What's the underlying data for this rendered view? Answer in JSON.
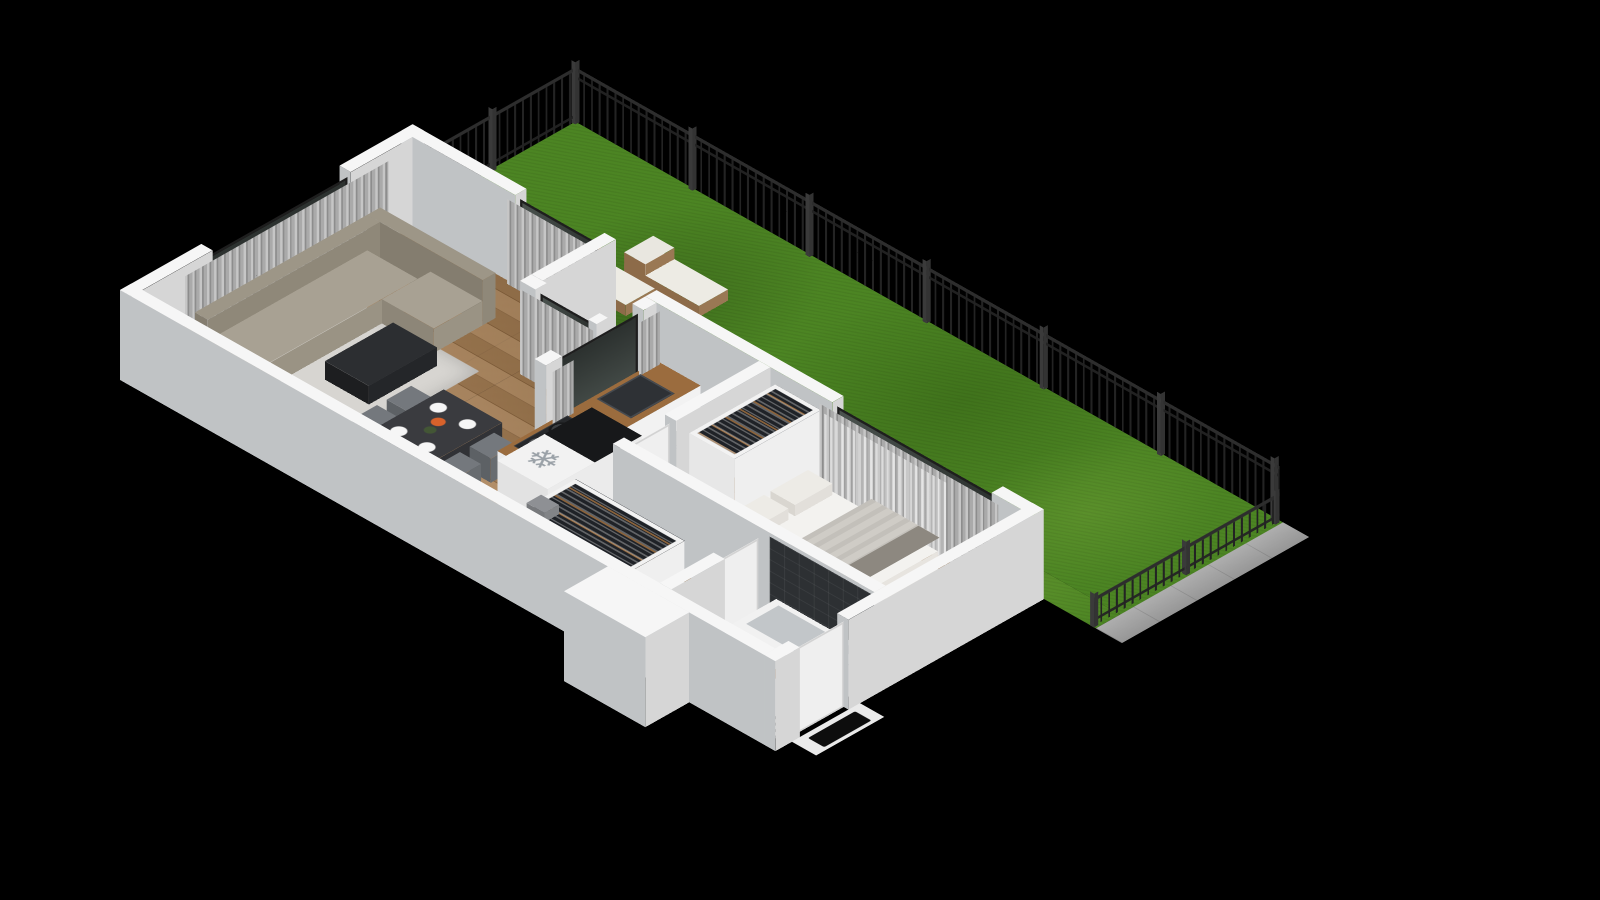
{
  "meta": {
    "description": "3D isometric floor plan rendering of a one-bedroom apartment with a fenced garden terrace",
    "background": "#000000"
  },
  "palette": {
    "wall_top": "#f6f6f6",
    "wall_sw": "#c0c3c5",
    "wall_se": "#d6d6d6",
    "wood_floor": "#ad8254",
    "grass": "#4c8523",
    "fence": "#2d2d2d",
    "sofa": "#a29b8d",
    "curtain": "#aaaaaa",
    "glass": "#39403d",
    "counter_wood": "#9b6c3e",
    "bed": "#f3f2ef",
    "dark_tile": "#2d3033",
    "pavement": "#a7a7a7"
  },
  "icons": {
    "snowflake": "❄"
  },
  "flats": [
    {
      "n": "garden-lawn",
      "x": 360,
      "y": 0,
      "w": 200,
      "d": 870,
      "cls": "grass"
    },
    {
      "n": "garden-lawn-strip",
      "x": 330,
      "y": 250,
      "w": 30,
      "d": 620,
      "cls": "grass"
    },
    {
      "n": "terrace-lawn-notch",
      "x": 270,
      "y": 250,
      "w": 90,
      "d": 80,
      "cls": "grass"
    },
    {
      "n": "pavement",
      "x": 330,
      "y": 870,
      "w": 230,
      "d": 32,
      "cls": "pavement"
    },
    {
      "n": "floor-living",
      "x": 14,
      "y": 14,
      "w": 332,
      "d": 222,
      "cls": "wood"
    },
    {
      "n": "floor-dining",
      "x": 14,
      "y": 236,
      "w": 242,
      "d": 94,
      "cls": "wood"
    },
    {
      "n": "floor-kitchen",
      "x": 14,
      "y": 330,
      "w": 302,
      "d": 130,
      "cls": "wood"
    },
    {
      "n": "floor-kitchen-tiles",
      "x": 150,
      "y": 344,
      "w": 166,
      "d": 116,
      "cls": "tile-kitchen"
    },
    {
      "n": "floor-hallway",
      "x": 14,
      "y": 460,
      "w": 122,
      "d": 190,
      "cls": "wood"
    },
    {
      "n": "floor-bedroom",
      "x": 150,
      "y": 484,
      "w": 166,
      "d": 308,
      "cls": "wood"
    },
    {
      "n": "floor-bathroom",
      "x": 14,
      "y": 664,
      "w": 122,
      "d": 128,
      "cls": "tile-bath"
    },
    {
      "n": "floor-shower",
      "x": 14,
      "y": 664,
      "w": 64,
      "d": 56,
      "cls": "shower"
    },
    {
      "n": "entry-threshold",
      "x": 20,
      "y": 806,
      "w": 84,
      "d": 30,
      "t": "#eaeaea"
    },
    {
      "n": "entry-doormat",
      "x": 34,
      "y": 812,
      "w": 58,
      "d": 20,
      "cls": "mat"
    },
    {
      "n": "living-rug",
      "x": 50,
      "y": 36,
      "w": 180,
      "d": 176,
      "cls": "rug"
    },
    {
      "n": "dining-table-setting",
      "x": 68,
      "y": 244,
      "w": 86,
      "d": 64,
      "z": 31,
      "cls": "plates"
    },
    {
      "n": "cooktop",
      "x": 134,
      "y": 350,
      "w": 66,
      "d": 42,
      "z": 35,
      "cls": "cooktop"
    },
    {
      "n": "kitchen-sink",
      "x": 236,
      "y": 350,
      "w": 54,
      "d": 42,
      "z": 35,
      "cls": "sink"
    },
    {
      "n": "snowflake-icon",
      "x": 66,
      "y": 410,
      "w": 46,
      "d": 46,
      "z": 83,
      "cls": "glyph",
      "glyph": "snowflake"
    },
    {
      "n": "bed-blanket",
      "x": 168,
      "y": 646,
      "w": 110,
      "d": 82,
      "z": 53,
      "cls": "blanket"
    },
    {
      "n": "bed-throw",
      "x": 168,
      "y": 704,
      "w": 110,
      "d": 26,
      "z": 53,
      "t": "#8d8880"
    },
    {
      "n": "tub-basin",
      "x": 88,
      "y": 682,
      "w": 40,
      "d": 96,
      "z": 31,
      "t": "#c2c6c9"
    },
    {
      "n": "vanity-basin",
      "x": 24,
      "y": 712,
      "w": 20,
      "d": 38,
      "z": 39,
      "cls": "basin"
    }
  ],
  "boxes": [
    {
      "n": "wall-nw-west",
      "x": 0,
      "y": 0,
      "w": 100,
      "d": 14,
      "h": 95,
      "wall": true
    },
    {
      "n": "wall-nw-east",
      "x": 270,
      "y": 0,
      "w": 90,
      "d": 14,
      "h": 95,
      "wall": true
    },
    {
      "n": "wall-ne-living",
      "x": 346,
      "y": 0,
      "w": 14,
      "d": 140,
      "h": 95,
      "wall": true
    },
    {
      "n": "wall-terrace-nw",
      "x": 270,
      "y": 236,
      "w": 90,
      "d": 14,
      "h": 95,
      "wall": true
    },
    {
      "n": "wall-terrace-sw-a",
      "x": 256,
      "y": 236,
      "w": 14,
      "d": 19,
      "h": 95,
      "wall": true
    },
    {
      "n": "wall-terrace-sw-b",
      "x": 256,
      "y": 320,
      "w": 14,
      "d": 10,
      "h": 95,
      "wall": true
    },
    {
      "n": "wall-kitchen-nw-a",
      "x": 180,
      "y": 330,
      "w": 20,
      "d": 14,
      "h": 95,
      "wall": true
    },
    {
      "n": "wall-kitchen-nw-b",
      "x": 300,
      "y": 330,
      "w": 16,
      "d": 14,
      "h": 95,
      "wall": true
    },
    {
      "n": "wall-ne-kitchen-bedroom",
      "x": 316,
      "y": 330,
      "w": 14,
      "d": 230,
      "h": 95,
      "wall": true
    },
    {
      "n": "wall-ne-bedroom-end",
      "x": 316,
      "y": 756,
      "w": 14,
      "d": 50,
      "h": 95,
      "wall": true
    },
    {
      "n": "wall-se-a",
      "x": 0,
      "y": 792,
      "w": 30,
      "d": 14,
      "h": 95,
      "wall": true
    },
    {
      "n": "wall-se-b",
      "x": 90,
      "y": 792,
      "w": 240,
      "d": 14,
      "h": 95,
      "wall": true
    },
    {
      "n": "wall-sw",
      "x": 0,
      "y": 0,
      "w": 14,
      "d": 792,
      "h": 95,
      "wall": true
    },
    {
      "n": "wall-stub-exterior",
      "x": -54,
      "y": 600,
      "w": 54,
      "d": 100,
      "h": 95,
      "wall": true
    },
    {
      "n": "wall-bedroom-sw",
      "x": 136,
      "y": 470,
      "w": 14,
      "d": 322,
      "h": 95,
      "wall": true
    },
    {
      "n": "wall-bedroom-nw",
      "x": 200,
      "y": 470,
      "w": 116,
      "d": 14,
      "h": 95,
      "wall": true
    },
    {
      "n": "wall-bathroom-nw",
      "x": 14,
      "y": 650,
      "w": 66,
      "d": 14,
      "h": 95,
      "wall": true
    },
    {
      "n": "sofa-back",
      "x": 70,
      "y": 22,
      "w": 212,
      "d": 16,
      "h": 48,
      "t": "#9d9687",
      "s1": "#847d6f",
      "s2": "#8f8879"
    },
    {
      "n": "sofa-armrest",
      "x": 54,
      "y": 22,
      "w": 16,
      "d": 80,
      "h": 40,
      "t": "#9d9687",
      "s1": "#847d6f",
      "s2": "#8f8879"
    },
    {
      "n": "sofa-seat",
      "x": 70,
      "y": 38,
      "w": 196,
      "d": 62,
      "h": 26,
      "t": "#a8a193",
      "s1": "#8d8678",
      "s2": "#9a9384"
    },
    {
      "n": "sofa-back-corner",
      "x": 282,
      "y": 22,
      "w": 16,
      "d": 142,
      "h": 48,
      "t": "#9d9687",
      "s1": "#847d6f",
      "s2": "#8f8879"
    },
    {
      "n": "sofa-chaise",
      "x": 222,
      "y": 100,
      "w": 60,
      "d": 64,
      "h": 26,
      "t": "#a8a193",
      "s1": "#8d8678",
      "s2": "#9a9384"
    },
    {
      "n": "coffee-table",
      "x": 126,
      "y": 126,
      "w": 84,
      "d": 54,
      "h": 20,
      "t": "#2c2e31",
      "s1": "#1d1e20",
      "s2": "#242629"
    },
    {
      "n": "dining-table",
      "x": 64,
      "y": 240,
      "w": 94,
      "d": 72,
      "h": 30,
      "t": "#3a3b3f",
      "s1": "#27282b",
      "s2": "#313236"
    },
    {
      "n": "dining-chair-1",
      "x": 74,
      "y": 212,
      "w": 30,
      "d": 26,
      "h": 26,
      "t": "#74787d",
      "s1": "#5d6165",
      "s2": "#686c70"
    },
    {
      "n": "dining-chair-2",
      "x": 116,
      "y": 212,
      "w": 30,
      "d": 26,
      "h": 26,
      "t": "#74787d",
      "s1": "#5d6165",
      "s2": "#686c70"
    },
    {
      "n": "dining-chair-3",
      "x": 74,
      "y": 314,
      "w": 30,
      "d": 26,
      "h": 26,
      "t": "#74787d",
      "s1": "#5d6165",
      "s2": "#686c70"
    },
    {
      "n": "dining-chair-4",
      "x": 116,
      "y": 314,
      "w": 30,
      "d": 26,
      "h": 26,
      "t": "#74787d",
      "s1": "#5d6165",
      "s2": "#686c70"
    },
    {
      "n": "living-plant",
      "x": 20,
      "y": 214,
      "w": 18,
      "d": 18,
      "h": 14,
      "t": "#4e7d35",
      "s1": "#2e2e2e",
      "s2": "#3a3a3a"
    },
    {
      "n": "kitchen-counter",
      "x": 120,
      "y": 344,
      "w": 196,
      "d": 54,
      "h": 34,
      "t": "#9b6c3e",
      "s1": "#ececec",
      "s2": "#f2f2f2"
    },
    {
      "n": "kitchen-faucet",
      "x": 254,
      "y": 344,
      "w": 10,
      "d": 8,
      "h": 14,
      "t": "#2b2b2b",
      "s1": "#1f1f1f",
      "s2": "#262626"
    },
    {
      "n": "fridge",
      "x": 60,
      "y": 404,
      "w": 58,
      "d": 62,
      "h": 82,
      "t": "#f2f2f2",
      "s1": "#e2e2e2",
      "s2": "#ebebeb"
    },
    {
      "n": "tall-cabinet",
      "x": 118,
      "y": 404,
      "w": 58,
      "d": 62,
      "h": 82,
      "t": "#17181a",
      "s1": "#e2e2e2",
      "s2": "#ebebeb"
    },
    {
      "n": "hallway-wardrobe",
      "x": 20,
      "y": 470,
      "w": 70,
      "d": 134,
      "h": 80,
      "tcls": "clothes",
      "s1": "#e7e7e7",
      "s2": "#efefef"
    },
    {
      "n": "hallway-wardrobe-box",
      "x": 24,
      "y": 476,
      "w": 18,
      "d": 22,
      "h": 10,
      "z": 80,
      "t": "#8e9094",
      "s1": "#77797c",
      "s2": "#828487"
    },
    {
      "n": "bedroom-wardrobe",
      "x": 210,
      "y": 490,
      "w": 106,
      "d": 56,
      "h": 80,
      "tcls": "clothes",
      "s1": "#e7e7e7",
      "s2": "#efefef"
    },
    {
      "n": "storage-box-1",
      "x": 152,
      "y": 500,
      "w": 32,
      "d": 34,
      "h": 30,
      "t": "#3b3d41",
      "s1": "#2c2e31",
      "s2": "#343639"
    },
    {
      "n": "storage-box-2",
      "x": 152,
      "y": 540,
      "w": 32,
      "d": 30,
      "h": 16,
      "t": "#4a4c50",
      "s1": "#3a3c3f",
      "s2": "#424447"
    },
    {
      "n": "bed-base",
      "x": 164,
      "y": 560,
      "w": 118,
      "d": 172,
      "h": 14,
      "t": "#dad7d1",
      "s1": "#b8b5af",
      "s2": "#c6c3bd"
    },
    {
      "n": "bed-mattress",
      "x": 168,
      "y": 564,
      "w": 110,
      "d": 164,
      "h": 38,
      "t": "#f3f2ef",
      "s1": "#dcd9d3",
      "s2": "#e7e4df"
    },
    {
      "n": "bed-pillow-1",
      "x": 174,
      "y": 572,
      "w": 46,
      "d": 30,
      "h": 50,
      "t": "#edebe6",
      "s1": "#d9d6d0",
      "s2": "#e2dfda"
    },
    {
      "n": "bed-pillow-2",
      "x": 228,
      "y": 572,
      "w": 46,
      "d": 30,
      "h": 50,
      "t": "#edebe6",
      "s1": "#d9d6d0",
      "s2": "#e2dfda"
    },
    {
      "n": "bedroom-plant",
      "x": 154,
      "y": 544,
      "w": 16,
      "d": 16,
      "h": 16,
      "t": "#47752f",
      "s1": "#2d2d2d",
      "s2": "#343434"
    },
    {
      "n": "bathtub",
      "x": 80,
      "y": 672,
      "w": 56,
      "d": 116,
      "h": 30,
      "t": "#f1f1f1",
      "s1": "#dcdcdc",
      "s2": "#e6e6e6"
    },
    {
      "n": "bathroom-vanity",
      "x": 20,
      "y": 704,
      "w": 30,
      "d": 62,
      "h": 38,
      "t": "#a57748",
      "s1": "#efefef",
      "s2": "#f4f4f4"
    },
    {
      "n": "sun-lounger-1",
      "x": 380,
      "y": 150,
      "w": 36,
      "d": 92,
      "h": 12,
      "t": "#edebe4",
      "s1": "#8d6b49",
      "s2": "#9a7854"
    },
    {
      "n": "sun-lounger-1-backrest",
      "x": 380,
      "y": 150,
      "w": 36,
      "d": 26,
      "h": 24,
      "t": "#e9e7e0",
      "s1": "#8d6b49",
      "s2": "#9a7854"
    },
    {
      "n": "sun-lounger-2",
      "x": 424,
      "y": 196,
      "w": 36,
      "d": 92,
      "h": 12,
      "t": "#edebe4",
      "s1": "#8d6b49",
      "s2": "#9a7854"
    },
    {
      "n": "sun-lounger-2-backrest",
      "x": 424,
      "y": 196,
      "w": 36,
      "d": 26,
      "h": 24,
      "t": "#e9e7e0",
      "s1": "#8d6b49",
      "s2": "#9a7854"
    },
    {
      "n": "garden-potted-plant",
      "x": 368,
      "y": 300,
      "w": 22,
      "d": 22,
      "h": 18,
      "t": "#4d7c33",
      "s1": "#2d2d2d",
      "s2": "#343434"
    },
    {
      "n": "terrace-bush",
      "x": 336,
      "y": 308,
      "w": 24,
      "d": 22,
      "h": 20,
      "t": "#47752f",
      "s1": "#35592a",
      "s2": "#3d6330"
    },
    {
      "n": "fence-post-1",
      "x": 357,
      "y": -2,
      "w": 5,
      "d": 5,
      "h": 66,
      "post": true
    },
    {
      "n": "fence-post-2",
      "x": 455,
      "y": -2,
      "w": 5,
      "d": 5,
      "h": 66,
      "post": true
    },
    {
      "n": "fence-post-corner",
      "x": 557,
      "y": -2,
      "w": 5,
      "d": 5,
      "h": 66,
      "post": true
    },
    {
      "n": "fence-post-3",
      "x": 557,
      "y": 142,
      "w": 5,
      "d": 5,
      "h": 66,
      "post": true
    },
    {
      "n": "fence-post-4",
      "x": 557,
      "y": 286,
      "w": 5,
      "d": 5,
      "h": 66,
      "post": true
    },
    {
      "n": "fence-post-5",
      "x": 557,
      "y": 430,
      "w": 5,
      "d": 5,
      "h": 66,
      "post": true
    },
    {
      "n": "fence-post-6",
      "x": 557,
      "y": 574,
      "w": 5,
      "d": 5,
      "h": 66,
      "post": true
    },
    {
      "n": "fence-post-7",
      "x": 557,
      "y": 718,
      "w": 5,
      "d": 5,
      "h": 66,
      "post": true
    },
    {
      "n": "fence-post-8",
      "x": 557,
      "y": 858,
      "w": 5,
      "d": 5,
      "h": 66,
      "post": true
    },
    {
      "n": "low-fence-post-1",
      "x": 330,
      "y": 863,
      "w": 5,
      "d": 5,
      "h": 36,
      "post": true
    },
    {
      "n": "low-fence-post-2",
      "x": 443,
      "y": 863,
      "w": 5,
      "d": 5,
      "h": 36,
      "post": true
    },
    {
      "n": "low-fence-post-3",
      "x": 553,
      "y": 863,
      "w": 5,
      "d": 5,
      "h": 36,
      "post": true
    }
  ],
  "panels": [
    {
      "n": "living-window-glass",
      "axis": "x",
      "x": 100,
      "y": 10,
      "len": 170,
      "h": 88,
      "cls": "glass"
    },
    {
      "n": "balcony-railing",
      "axis": "x",
      "x": 96,
      "y": -2,
      "len": 178,
      "h": 38,
      "cls": "railing"
    },
    {
      "n": "living-curtain-nw",
      "axis": "x",
      "x": 60,
      "y": 20,
      "len": 250,
      "h": 90,
      "cls": "curtain"
    },
    {
      "n": "living-glass-ne",
      "axis": "y",
      "x": 352,
      "y": 140,
      "len": 96,
      "h": 88,
      "cls": "glass"
    },
    {
      "n": "living-curtain-ne",
      "axis": "y",
      "x": 342,
      "y": 134,
      "len": 108,
      "h": 90,
      "cls": "curtain"
    },
    {
      "n": "terrace-door-glass",
      "axis": "y",
      "x": 262,
      "y": 255,
      "len": 65,
      "h": 88,
      "cls": "glass"
    },
    {
      "n": "terrace-door-curtain",
      "axis": "y",
      "x": 252,
      "y": 240,
      "len": 90,
      "h": 90,
      "cls": "curtain"
    },
    {
      "n": "kitchen-window-glass",
      "axis": "x",
      "x": 200,
      "y": 337,
      "len": 100,
      "h": 88,
      "cls": "glass"
    },
    {
      "n": "kitchen-curtain-left",
      "axis": "x",
      "x": 182,
      "y": 350,
      "len": 26,
      "h": 90,
      "cls": "curtain"
    },
    {
      "n": "kitchen-curtain-right",
      "axis": "x",
      "x": 288,
      "y": 350,
      "len": 26,
      "h": 90,
      "cls": "curtain"
    },
    {
      "n": "bedroom-window-glass",
      "axis": "y",
      "x": 322,
      "y": 560,
      "len": 196,
      "h": 88,
      "cls": "glass"
    },
    {
      "n": "bedroom-curtain",
      "axis": "y",
      "x": 312,
      "y": 548,
      "len": 220,
      "h": 90,
      "cls": "curtain"
    },
    {
      "n": "bedroom-sheer-curtain",
      "axis": "y",
      "x": 306,
      "y": 560,
      "len": 150,
      "h": 88,
      "cls": "sheer"
    },
    {
      "n": "bathroom-dark-tile-wall",
      "axis": "y",
      "x": 135,
      "y": 664,
      "len": 128,
      "h": 92,
      "cls": "tile-dark"
    },
    {
      "n": "entry-door",
      "axis": "x",
      "x": 30,
      "y": 800,
      "len": 60,
      "h": 90,
      "cls": "door"
    },
    {
      "n": "bathroom-door",
      "axis": "x",
      "x": 80,
      "y": 655,
      "len": 50,
      "h": 88,
      "cls": "door"
    },
    {
      "n": "bedroom-door",
      "axis": "x",
      "x": 150,
      "y": 476,
      "len": 50,
      "h": 88,
      "cls": "door"
    },
    {
      "n": "garden-fence-nw",
      "axis": "x",
      "x": 360,
      "y": 0,
      "len": 200,
      "h": 58,
      "cls": "fence"
    },
    {
      "n": "garden-fence-ne",
      "axis": "y",
      "x": 560,
      "y": 0,
      "len": 866,
      "h": 58,
      "cls": "fence"
    },
    {
      "n": "garden-fence-low-se",
      "axis": "x",
      "x": 330,
      "y": 866,
      "len": 230,
      "h": 30,
      "cls": "fence"
    }
  ]
}
